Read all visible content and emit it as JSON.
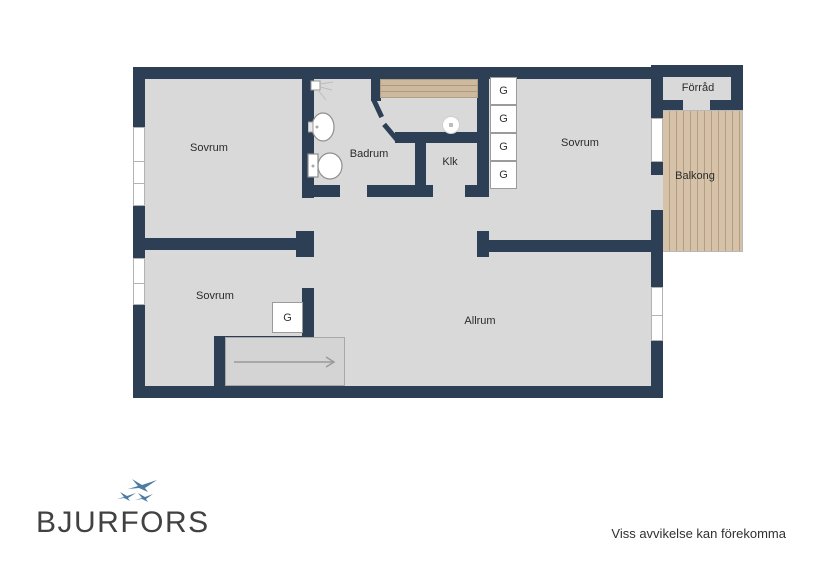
{
  "plan_title": "floor-plan",
  "colors": {
    "wall": "#2d3f54",
    "floor": "#d9d9d9",
    "balcony_wood": "#d5c2a8",
    "window": "#ffffff",
    "label_text": "#2b2b2b",
    "logo_text": "#414141",
    "logo_bird_blue": "#4e7ba3"
  },
  "rooms": [
    {
      "name": "sovrum-top-left",
      "label": "Sovrum"
    },
    {
      "name": "badrum",
      "label": "Badrum"
    },
    {
      "name": "klk",
      "label": "Klk"
    },
    {
      "name": "sovrum-top-right",
      "label": "Sovrum"
    },
    {
      "name": "forrad",
      "label": "Förråd"
    },
    {
      "name": "balkong",
      "label": "Balkong"
    },
    {
      "name": "sovrum-bottom-left",
      "label": "Sovrum"
    },
    {
      "name": "allrum",
      "label": "Allrum"
    }
  ],
  "wardrobe": {
    "label": "G",
    "count": 5
  },
  "fixtures": [
    "shower-icon",
    "sink-icon",
    "toilet-icon",
    "spotlight-icon"
  ],
  "stairs": {
    "arrow_direction": "right"
  },
  "footer": {
    "logo_text": "BJURFORS",
    "disclaimer": "Viss avvikelse kan förekomma"
  }
}
